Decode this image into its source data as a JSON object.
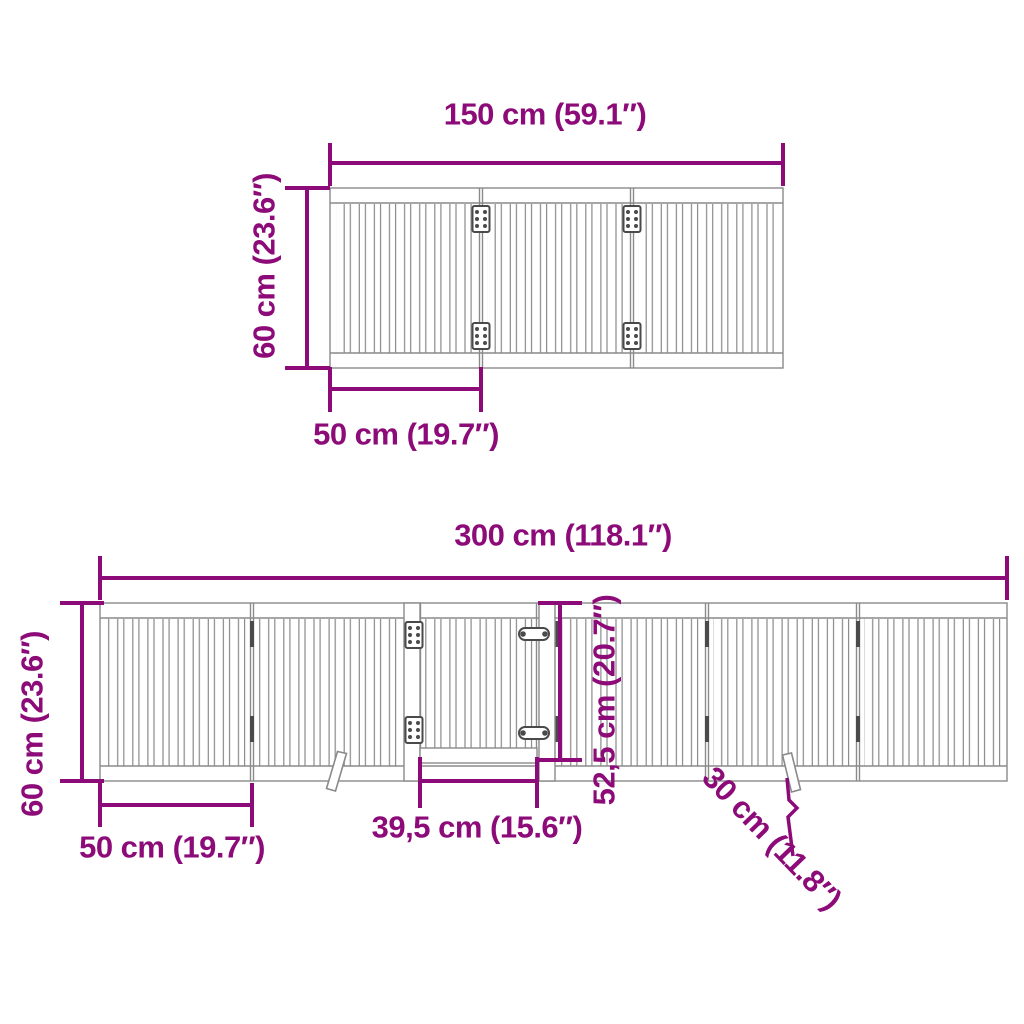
{
  "colors": {
    "dimension": "#8D0B78",
    "outline": "#8A8A8A",
    "hardware": "#4A4A4A",
    "background": "#FFFFFF"
  },
  "top_diagram": {
    "panels": 3,
    "labels": {
      "total_width": "150 cm (59.1″)",
      "height": "60 cm (23.6″)",
      "panel_width": "50 cm (19.7″)"
    }
  },
  "bottom_diagram": {
    "panels": 6,
    "labels": {
      "total_width": "300 cm (118.1″)",
      "height": "60 cm (23.6″)",
      "panel_width": "50 cm (19.7″)",
      "door_width": "39,5 cm (15.6″)",
      "door_height": "52,5 cm (20.7″)",
      "foot_depth": "30 cm (11.8″)"
    }
  }
}
